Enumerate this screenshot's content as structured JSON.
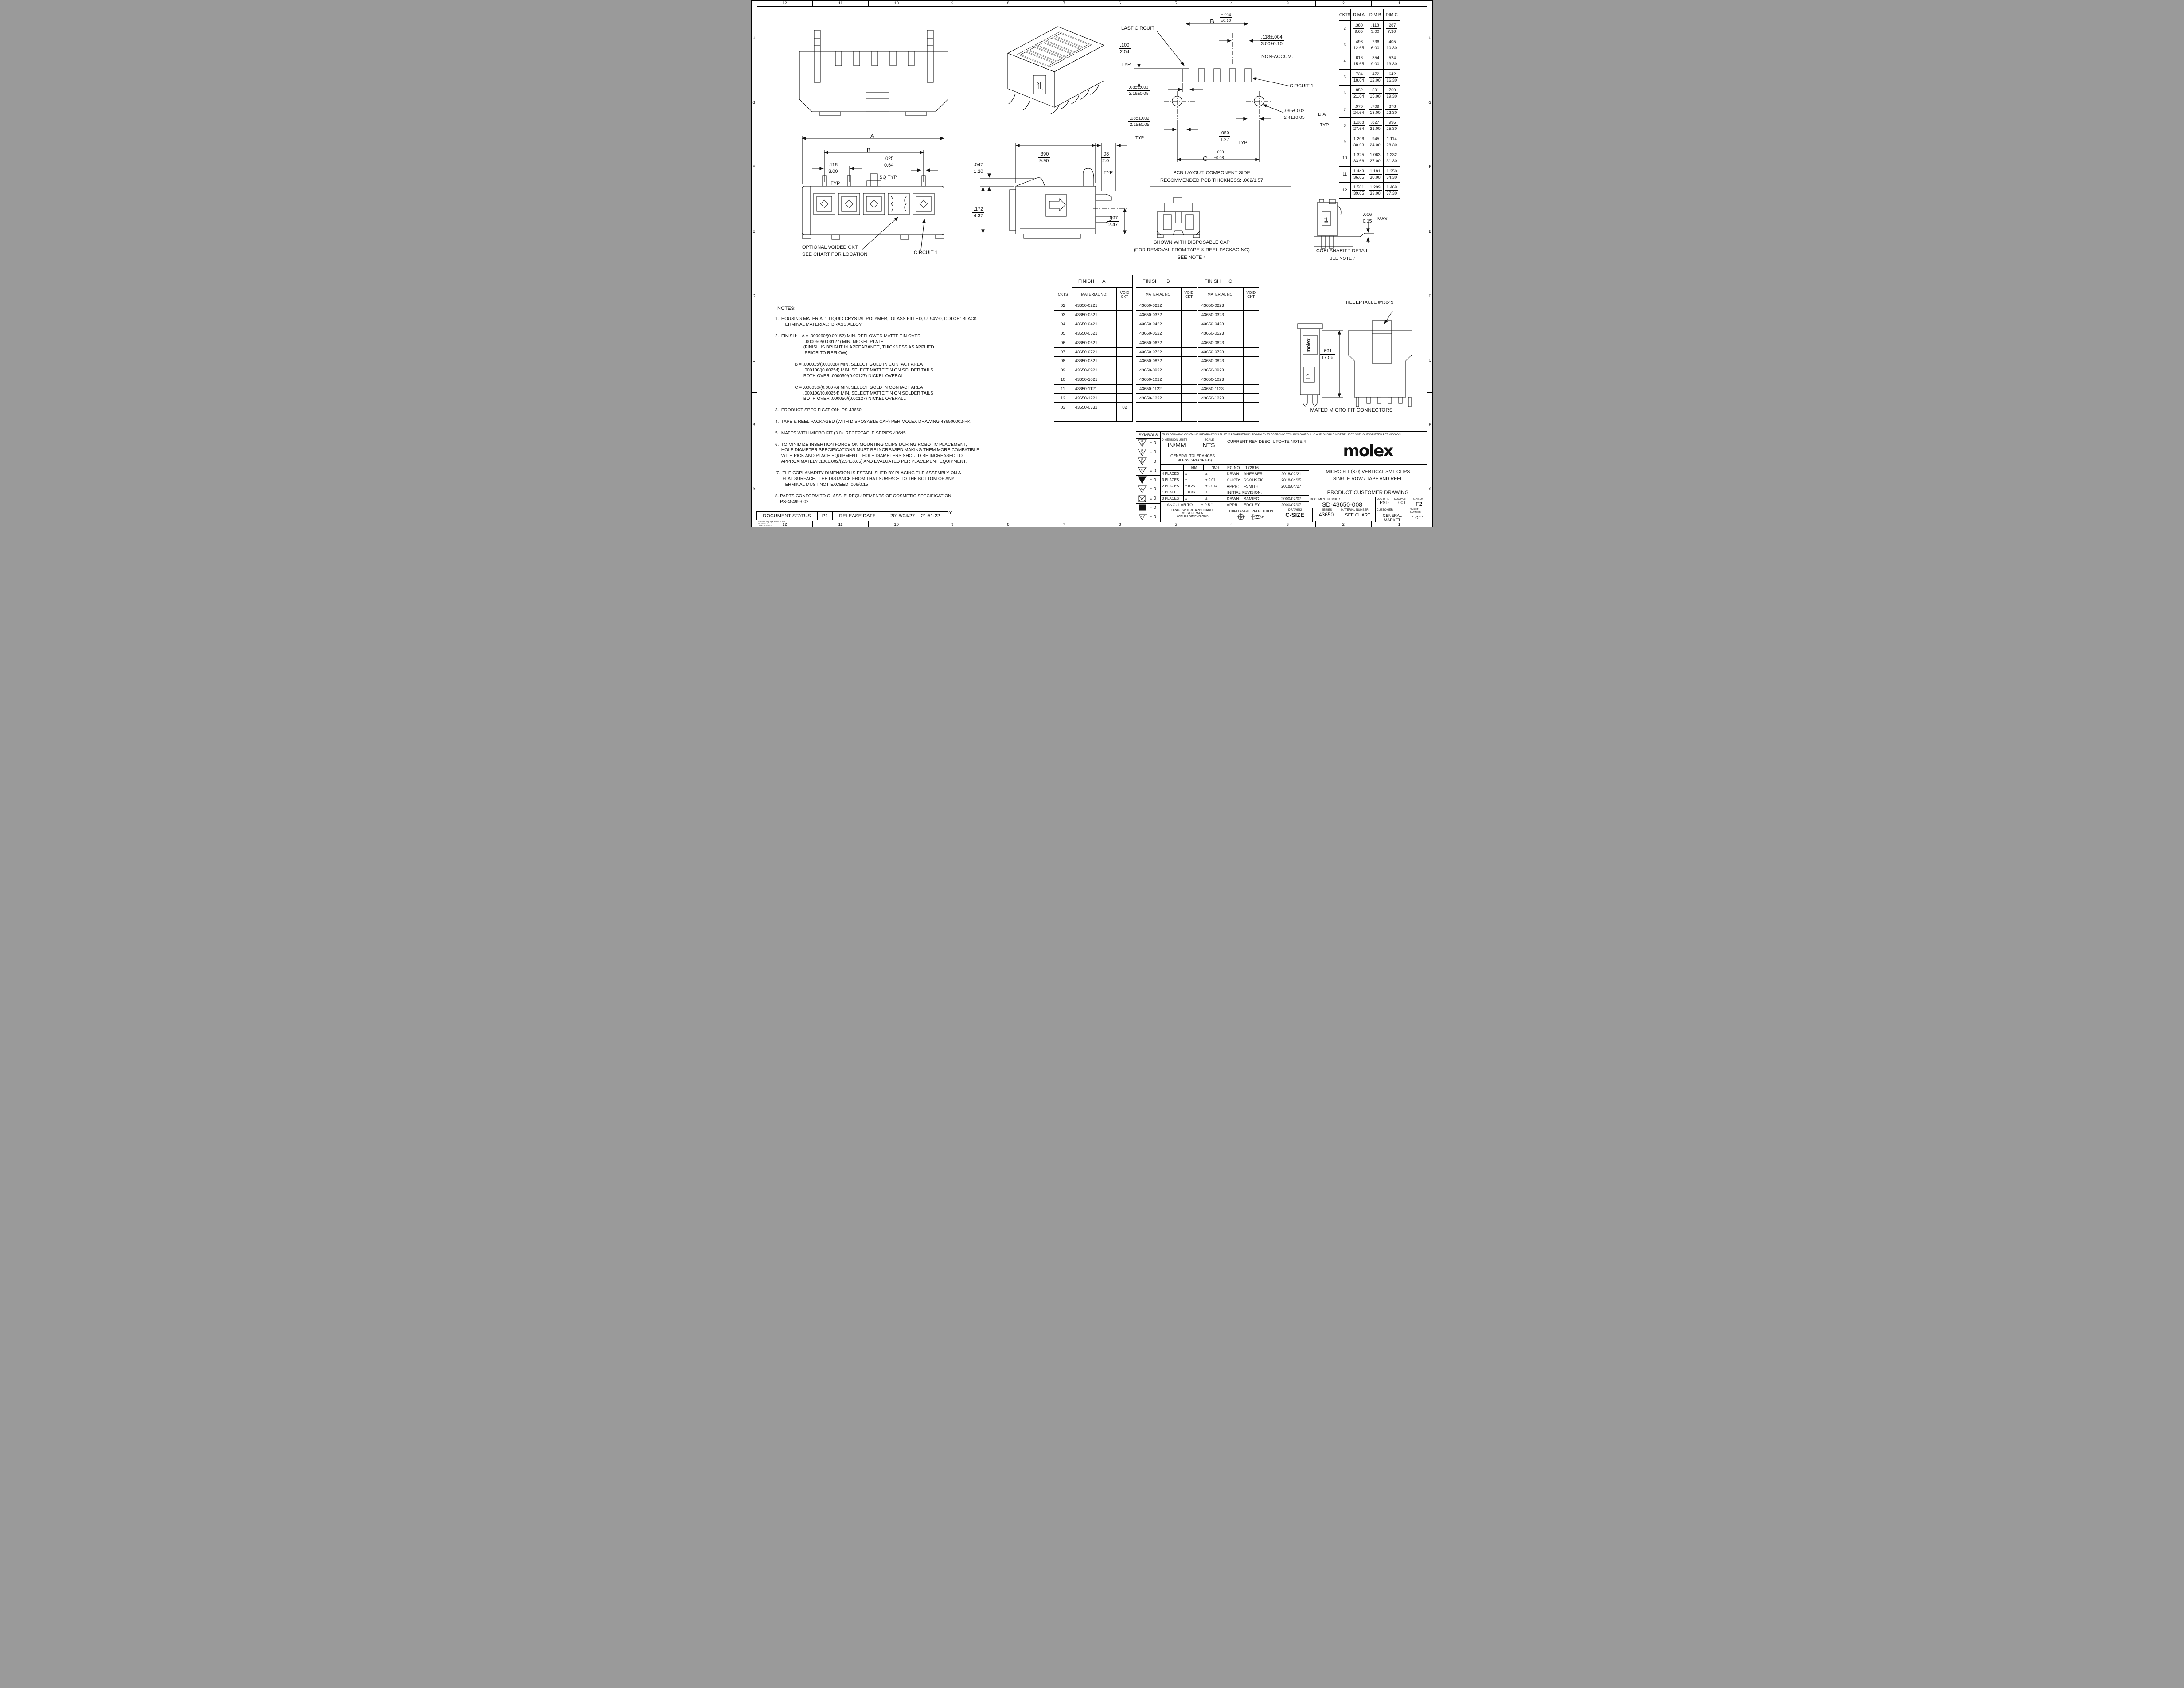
{
  "zones": {
    "top": [
      "12",
      "11",
      "10",
      "9",
      "8",
      "7",
      "6",
      "5",
      "4",
      "3",
      "2",
      "1"
    ],
    "bottom": [
      "12",
      "11",
      "10",
      "9",
      "8",
      "7",
      "6",
      "5",
      "4",
      "3",
      "2",
      "1"
    ],
    "left": [
      "H",
      "G",
      "F",
      "E",
      "D",
      "C",
      "B",
      "A"
    ],
    "right": [
      "H",
      "G",
      "F",
      "E",
      "D",
      "C",
      "B",
      "A"
    ]
  },
  "dim_table": {
    "headers": [
      "CKTS",
      "DIM A",
      "DIM B",
      "DIM C"
    ],
    "rows": [
      {
        "ckts": "2",
        "a_in": ".380",
        "a_mm": "9.65",
        "b_in": ".118",
        "b_mm": "3.00",
        "c_in": ".287",
        "c_mm": "7.30"
      },
      {
        "ckts": "3",
        "a_in": ".498",
        "a_mm": "12.65",
        "b_in": ".236",
        "b_mm": "6.00",
        "c_in": ".405",
        "c_mm": "10.30"
      },
      {
        "ckts": "4",
        "a_in": ".616",
        "a_mm": "15.65",
        "b_in": ".354",
        "b_mm": "9.00",
        "c_in": ".524",
        "c_mm": "13.30"
      },
      {
        "ckts": "5",
        "a_in": ".734",
        "a_mm": "18.64",
        "b_in": ".472",
        "b_mm": "12.00",
        "c_in": ".642",
        "c_mm": "16.30"
      },
      {
        "ckts": "6",
        "a_in": ".852",
        "a_mm": "21.64",
        "b_in": ".591",
        "b_mm": "15.00",
        "c_in": ".760",
        "c_mm": "19.30"
      },
      {
        "ckts": "7",
        "a_in": ".970",
        "a_mm": "24.64",
        "b_in": ".709",
        "b_mm": "18.00",
        "c_in": ".878",
        "c_mm": "22.30"
      },
      {
        "ckts": "8",
        "a_in": "1.088",
        "a_mm": "27.64",
        "b_in": ".827",
        "b_mm": "21.00",
        "c_in": ".996",
        "c_mm": "25.30"
      },
      {
        "ckts": "9",
        "a_in": "1.206",
        "a_mm": "30.63",
        "b_in": ".945",
        "b_mm": "24.00",
        "c_in": "1.114",
        "c_mm": "28.30"
      },
      {
        "ckts": "10",
        "a_in": "1.325",
        "a_mm": "33.66",
        "b_in": "1.063",
        "b_mm": "27.00",
        "c_in": "1.232",
        "c_mm": "31.30"
      },
      {
        "ckts": "11",
        "a_in": "1.443",
        "a_mm": "36.65",
        "b_in": "1.181",
        "b_mm": "30.00",
        "c_in": "1.350",
        "c_mm": "34.30"
      },
      {
        "ckts": "12",
        "a_in": "1.561",
        "a_mm": "39.65",
        "b_in": "1.299",
        "b_mm": "33.00",
        "c_in": "1.469",
        "c_mm": "37.30"
      }
    ]
  },
  "finish_a": {
    "title": "FINISH",
    "letter": "A",
    "col_ckts": "CKTS",
    "col_material": "MATERIAL NO:",
    "col_void": "VOID CKT",
    "rows": [
      {
        "ckts": "02",
        "mat": "43650-0221",
        "void": ""
      },
      {
        "ckts": "03",
        "mat": "43650-0321",
        "void": ""
      },
      {
        "ckts": "04",
        "mat": "43650-0421",
        "void": ""
      },
      {
        "ckts": "05",
        "mat": "43650-0521",
        "void": ""
      },
      {
        "ckts": "06",
        "mat": "43650-0621",
        "void": ""
      },
      {
        "ckts": "07",
        "mat": "43650-0721",
        "void": ""
      },
      {
        "ckts": "08",
        "mat": "43650-0821",
        "void": ""
      },
      {
        "ckts": "09",
        "mat": "43650-0921",
        "void": ""
      },
      {
        "ckts": "10",
        "mat": "43650-1021",
        "void": ""
      },
      {
        "ckts": "11",
        "mat": "43650-1121",
        "void": ""
      },
      {
        "ckts": "12",
        "mat": "43650-1221",
        "void": ""
      },
      {
        "ckts": "03",
        "mat": "43650-0332",
        "void": "02"
      },
      {
        "ckts": "",
        "mat": "",
        "void": ""
      }
    ]
  },
  "finish_b": {
    "title": "FINISH",
    "letter": "B",
    "col_material": "MATERIAL NO:",
    "col_void": "VOID CKT",
    "rows": [
      {
        "mat": "43650-0222",
        "void": ""
      },
      {
        "mat": "43650-0322",
        "void": ""
      },
      {
        "mat": "43650-0422",
        "void": ""
      },
      {
        "mat": "43650-0522",
        "void": ""
      },
      {
        "mat": "43650-0622",
        "void": ""
      },
      {
        "mat": "43650-0722",
        "void": ""
      },
      {
        "mat": "43650-0822",
        "void": ""
      },
      {
        "mat": "43650-0922",
        "void": ""
      },
      {
        "mat": "43650-1022",
        "void": ""
      },
      {
        "mat": "43650-1122",
        "void": ""
      },
      {
        "mat": "43650-1222",
        "void": ""
      },
      {
        "mat": "",
        "void": ""
      },
      {
        "mat": "",
        "void": ""
      }
    ]
  },
  "finish_c": {
    "title": "FINISH",
    "letter": "C",
    "col_material": "MATERIAL NO:",
    "col_void": "VOID CKT",
    "rows": [
      {
        "mat": "43650-0223",
        "void": ""
      },
      {
        "mat": "43650-0323",
        "void": ""
      },
      {
        "mat": "43650-0423",
        "void": ""
      },
      {
        "mat": "43650-0523",
        "void": ""
      },
      {
        "mat": "43650-0623",
        "void": ""
      },
      {
        "mat": "43650-0723",
        "void": ""
      },
      {
        "mat": "43650-0823",
        "void": ""
      },
      {
        "mat": "43650-0923",
        "void": ""
      },
      {
        "mat": "43650-1023",
        "void": ""
      },
      {
        "mat": "43650-1123",
        "void": ""
      },
      {
        "mat": "43650-1223",
        "void": ""
      },
      {
        "mat": "",
        "void": ""
      },
      {
        "mat": "",
        "void": ""
      }
    ]
  },
  "notes": {
    "heading": "NOTES:",
    "lines": [
      "1.  HOUSING MATERIAL:  LIQUID CRYSTAL POLYMER,  GLASS FILLED, UL94V-0, COLOR: BLACK",
      "      TERMINAL MATERIAL:  BRASS ALLOY",
      "",
      "2.  FINISH:    A = .000060/(0.00152) MIN. REFLOWED MATTE TIN OVER",
      "                        .000050/(0.00127) MIN. NICKEL PLATE",
      "                       (FINISH IS BRIGHT IN APPEARANCE, THICKNESS AS APPLIED",
      "                        PRIOR TO REFLOW)",
      "",
      "                B = .000015/(0.00038) MIN. SELECT GOLD IN CONTACT AREA",
      "                       .000100/(0.00254) MIN. SELECT MATTE TIN ON SOLDER TAILS",
      "                       BOTH OVER .000050/(0.00127) NICKEL OVERALL",
      "",
      "                C = .000030/(0.00076) MIN. SELECT GOLD IN CONTACT AREA",
      "                       .000100/(0.00254) MIN. SELECT MATTE TIN ON SOLDER TAILS",
      "                       BOTH OVER .000050/(0.00127) NICKEL OVERALL",
      "",
      "3.  PRODUCT SPECIFICATION:  PS-43650",
      "",
      "4.  TAPE & REEL PACKAGED (WITH DISPOSABLE CAP) PER MOLEX DRAWING 436500002-PK",
      "",
      "5.  MATES WITH MICRO FIT (3.0)  RECEPTACLE SERIES 43645",
      "",
      "6.  TO MINIMIZE INSERTION FORCE ON MOUNTING CLIPS DURING ROBOTIC PLACEMENT,",
      "     HOLE DIAMETER SPECIFICATIONS MUST BE INCREASED MAKING THEM MORE COMPATIBLE",
      "     WITH PICK AND PLACE EQUIPMENT.   HOLE DIAMETERS SHOULD BE INCREASED TO",
      "     APPROXIMATELY .100±.002/(2.54±0.05) AND EVALUATED PER PLACEMENT EQUIPMENT.",
      "",
      " 7.  THE COPLANARITY DIMENSION IS ESTABLISHED BY PLACING THE ASSEMBLY ON A",
      "      FLAT SURFACE.  THE DISTANCE FROM THAT SURFACE TO THE BOTTOM OF ANY",
      "      TERMINAL MUST NOT EXCEED .006/0.15",
      "",
      "8. PARTS CONFORM TO CLASS 'B' REQUIREMENTS OF COSMETIC SPECIFICATION",
      "    PS-45499-002",
      "",
      "9. TEXT ON PART IS FOR REFERENCE ONLY. TEXT AND TEXT LOCATION MAY VARY",
      "     DEPENDING ON PART NUMBER AND/OR TOOL"
    ]
  },
  "front_view": {
    "dim_a": "A",
    "dim_b": "B",
    "pitch_in": ".118",
    "pitch_mm": "3.00",
    "pitch_suffix": "TYP",
    "sq_in": ".025",
    "sq_mm": "0.64",
    "sq_suffix": "SQ TYP",
    "voided_1": "OPTIONAL VOIDED CKT",
    "voided_2": "SEE CHART FOR LOCATION",
    "circuit1": "CIRCUIT 1"
  },
  "side_view": {
    "w_in": ".390",
    "w_mm": "9.90",
    "tab_in": ".08",
    "tab_mm": "2.0",
    "tab_suffix": "TYP",
    "h1_in": ".047",
    "h1_mm": "1.20",
    "h2_in": ".172",
    "h2_mm": "4.37",
    "h3_in": ".097",
    "h3_mm": "2.47"
  },
  "pcb": {
    "last_circuit": "LAST CIRCUIT",
    "b_label": "B",
    "b_tol_in": "±.004",
    "b_tol_mm": "±0.10",
    "pitch_in": ".118±.004",
    "pitch_mm": "3.00±0.10",
    "pitch_suffix": "NON-ACCUM.",
    "p100_in": ".100",
    "p100_mm": "2.54",
    "p100_suffix": "TYP.",
    "padw_in": ".085±.002",
    "padw_mm": "2.16±0.05",
    "padw2_in": ".085±.002",
    "padw2_mm": "2.15±0.05",
    "padw2_suffix": "TYP.",
    "gap_in": ".050",
    "gap_mm": "1.27",
    "gap_suffix": "TYP",
    "c_label": "C",
    "c_tol_in": "±.003",
    "c_tol_mm": "±0.08",
    "circuit1": "CIRCUIT 1",
    "hole_in": ".095±.002",
    "hole_mm": "2.41±0.05",
    "hole_suffix1": "DIA",
    "hole_suffix2": "TYP",
    "caption1": "PCB LAYOUT: COMPONENT SIDE",
    "caption2": "RECOMMENDED PCB THICKNESS: .062/1.57"
  },
  "cap_view": {
    "line1": "SHOWN WITH DISPOSABLE CAP",
    "line2": "(FOR REMOVAL FROM TAPE & REEL PACKAGING)",
    "line3": "SEE NOTE 4"
  },
  "coplanarity": {
    "dim_in": ".006",
    "dim_mm": "0.15",
    "suffix": "MAX",
    "title": "COPLANARITY DETAIL",
    "sub": "SEE NOTE  7"
  },
  "mated": {
    "receptacle": "RECEPTACLE #43645",
    "h_in": ".691",
    "h_mm": "17.56",
    "caption": "MATED MICRO FIT CONNECTORS"
  },
  "markings": {
    "one": "1"
  },
  "title_block": {
    "symbols_header": "SYMBOLS",
    "eq": "=",
    "symbols": [
      {
        "t": "F",
        "b": "A",
        "v": "0"
      },
      {
        "t": "F",
        "b": "C",
        "v": "0"
      },
      {
        "t": "F",
        "b": "P",
        "v": "0"
      },
      {
        "t": "S",
        "b": "",
        "v": "0"
      },
      {
        "t": "",
        "b": "",
        "v": "0"
      },
      {
        "t": "C",
        "b": "",
        "v": "0"
      },
      {
        "t": "",
        "b": "",
        "v": "0"
      },
      {
        "t": "",
        "b": "",
        "v": "0"
      },
      {
        "t": "C",
        "b": "",
        "v": "0"
      }
    ],
    "proprietary": "THIS DRAWING CONTAINS INFORMATION THAT IS PROPRIETARY TO MOLEX ELECTRONIC TECHNOLOGIES, LLC AND SHOULD NOT BE USED WITHOUT WRITTEN PERMISSION",
    "dimension_units_label": "DIMENSION UNITS",
    "dimension_units": "IN/MM",
    "scale_label": "SCALE",
    "scale": "NTS",
    "general_tol_1": "GENERAL TOLERANCES",
    "general_tol_2": "(UNLESS SPECIFIED)",
    "col_mm": "MM",
    "col_inch": "INCH",
    "tol_rows": [
      {
        "label": "4 PLACES",
        "mm": "±",
        "inch": "±"
      },
      {
        "label": "3 PLACES",
        "mm": "±",
        "inch": "±    0.01"
      },
      {
        "label": "2 PLACES",
        "mm": "±    0.25",
        "inch": "±   0.014"
      },
      {
        "label": "1 PLACE",
        "mm": "±    0.36",
        "inch": "±"
      },
      {
        "label": "0 PLACES",
        "mm": "±",
        "inch": "±"
      }
    ],
    "angular_label": "ANGULAR TOL",
    "angular_value": "±     0.5 °",
    "draft_1": "DRAFT WHERE APPLICABLE",
    "draft_2": "MUST REMAIN",
    "draft_3": "WITHIN DIMENSIONS",
    "current_rev": "CURRENT REV DESC: UPDATE NOTE 4",
    "ec_label": "EC NO:",
    "ec_no": "172616",
    "sig_rows": [
      {
        "label": "DRWN:",
        "name": "ANESSER",
        "date": "2018/02/21"
      },
      {
        "label": "CHK'D:",
        "name": "SSOUSEK",
        "date": "2018/04/25"
      },
      {
        "label": "APPR:",
        "name": "FSMITH",
        "date": "2018/04/27"
      }
    ],
    "initial_revision": "INITIAL REVISION:",
    "init_rows": [
      {
        "label": "DRWN:",
        "name": "SAMIEC",
        "date": "2000/07/07"
      },
      {
        "label": "APPR:",
        "name": "EDGLEY",
        "date": "2000/07/07"
      }
    ],
    "third_angle": "THIRD ANGLE PROJECTION",
    "drawing_label": "DRAWING",
    "drawing_size": "C-SIZE",
    "series_label": "SERIES",
    "series": "43650",
    "brand": "molex",
    "title_line1": "MICRO FIT (3.0) VERTICAL SMT CLIPS",
    "title_line2": "SINGLE ROW / TAPE AND REEL",
    "doc_title": "PRODUCT CUSTOMER DRAWING",
    "document_number_label": "DOCUMENT NUMBER",
    "document_number": "SD-43650-008",
    "doc_type_label": "DOC TYPE",
    "doc_type": "PSD",
    "doc_part_label": "DOC PART",
    "doc_part": "001",
    "revision_label": "REVISION",
    "revision": "F2",
    "material_number_label": "MATERIAL NUMBER",
    "material_number": "SEE CHART",
    "customer_label": "CUSTOMER",
    "customer": "GENERAL MARKET",
    "sheet_label": "SHEET NUMBER",
    "sheet": "1 OF 1"
  },
  "status_bar": {
    "label": "DOCUMENT STATUS",
    "status": "P1",
    "release_label": "RELEASE DATE",
    "date": "2018/04/27",
    "time": "21:51:22"
  },
  "format_note": {
    "line1": "FORMAT: Eng-loga-master-tb-prod-C",
    "line2": "REVISION: D",
    "line3": "DATE: 2018/01/18"
  }
}
